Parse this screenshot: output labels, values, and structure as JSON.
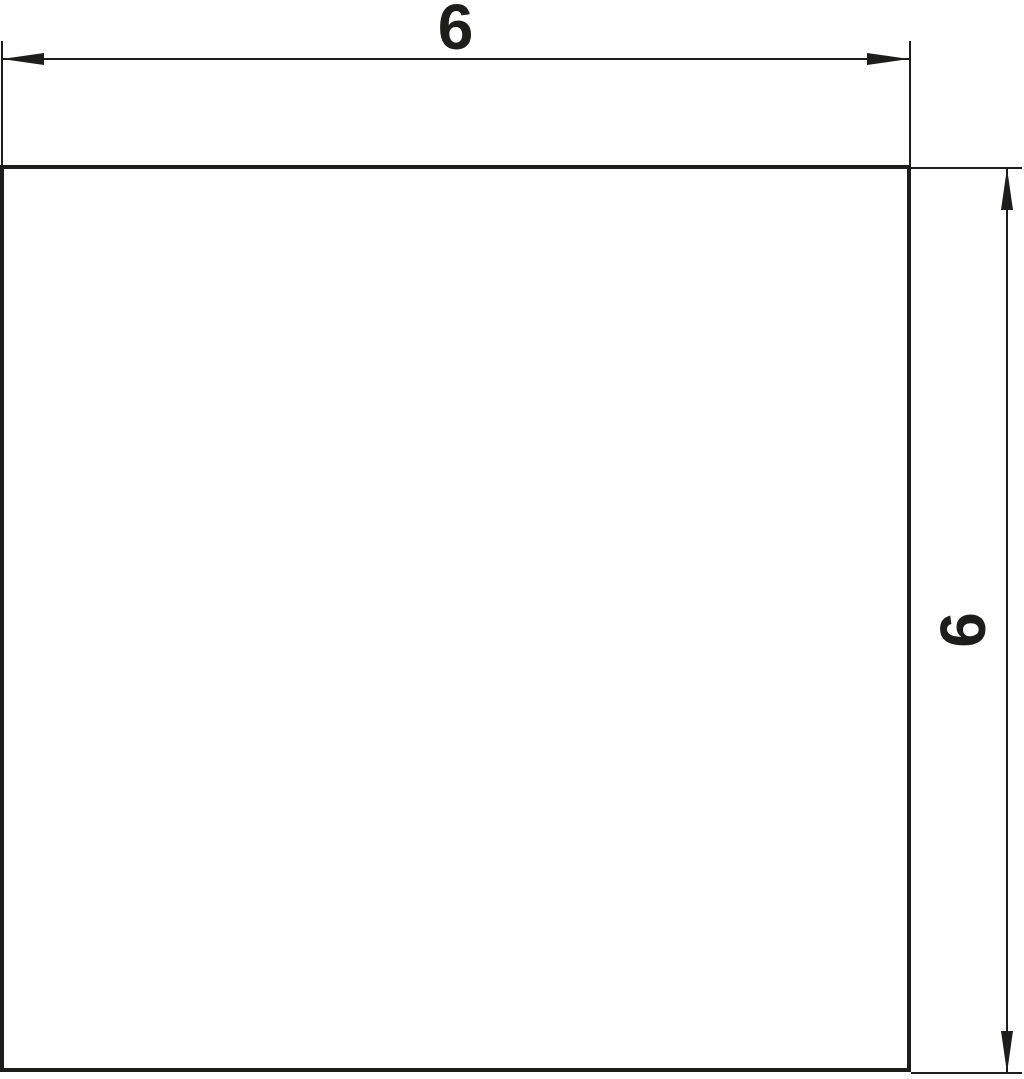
{
  "drawing": {
    "shape": "square",
    "horizontal_dimension": {
      "value": "6",
      "position": "top"
    },
    "vertical_dimension": {
      "value": "6",
      "position": "right",
      "text_rotation_deg": -90
    },
    "line_color": "#1d1d1b",
    "background_color": "#ffffff"
  }
}
